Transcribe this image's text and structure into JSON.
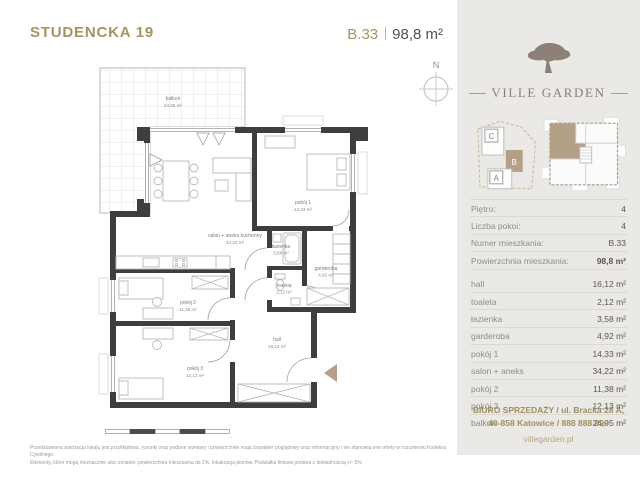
{
  "header": {
    "project": "STUDENCKA 19",
    "unit_number": "B.33",
    "unit_area": "98,8 m²"
  },
  "plan": {
    "compass_label": "N",
    "rooms": {
      "balkon": {
        "name": "balkon",
        "area": "24,95 m²"
      },
      "salon": {
        "name": "salon + aneks kuchenny",
        "area": "34,22 m²"
      },
      "pokoj1": {
        "name": "pokój 1",
        "area": "14,33 m²"
      },
      "lazienka": {
        "name": "łazienka",
        "area": "3,58 m²"
      },
      "toaleta": {
        "name": "toaleta",
        "area": "2,12 m²"
      },
      "garderoba": {
        "name": "garderoba",
        "area": "4,92 m²"
      },
      "pokoj2": {
        "name": "pokój 2",
        "area": "11,38 m²"
      },
      "pokoj3": {
        "name": "pokój 3",
        "area": "12,13 m²"
      },
      "hall": {
        "name": "hall",
        "area": "16,12 m²"
      }
    }
  },
  "sidebar": {
    "brand": "VILLE GARDEN",
    "site_plan_buildings": [
      "C",
      "B",
      "A"
    ],
    "info_rows": [
      {
        "label": "Piętro:",
        "value": "4"
      },
      {
        "label": "Liczba pokoi:",
        "value": "4"
      },
      {
        "label": "Numer mieszkania:",
        "value": "B.33"
      },
      {
        "label": "Powierzchnia mieszkania:",
        "value": "98,8 m²"
      }
    ],
    "room_rows": [
      {
        "label": "hall",
        "value": "16,12 m²"
      },
      {
        "label": "toaleta",
        "value": "2,12 m²"
      },
      {
        "label": "łazienka",
        "value": "3,58 m²"
      },
      {
        "label": "garderoba",
        "value": "4,92 m²"
      },
      {
        "label": "pokój 1",
        "value": "14,33 m²"
      },
      {
        "label": "salon + aneks",
        "value": "34,22 m²"
      },
      {
        "label": "pokój 2",
        "value": "11,38 m²"
      },
      {
        "label": "pokój 3",
        "value": "12,13 m²"
      },
      {
        "label": "balkon",
        "value": "24,95 m²"
      }
    ],
    "contact": {
      "line1": "BIURO SPRZEDAŻY / ul. Bracka 28 A,",
      "line2": "40-858 Katowice / 888 888 890",
      "website": "villegarden.pl"
    }
  },
  "footer": {
    "disclaimer_line1": "Przedstawiona aranżacja lokalu jest przykładowa, rysunki oraz podane wymiary i powierzchnie mają charakter poglądowy oraz informacyjny i nie stanowią one oferty w rozumieniu Kodeksu Cywilnego.",
    "disclaimer_line2": "Elementy, które mogą nieznacznie ulec zmianie: powierzchnia mieszkania do 2%, lokalizacja pionów. Podziałka liniowa podana z dokładnością +/- 5%."
  },
  "colors": {
    "accent_gold": "#a5935f",
    "highlight_tan": "#b3a086",
    "wall_dark": "#3e3e3e",
    "sidebar_bg": "#eae9e6",
    "logo_taupe": "#8d8076"
  }
}
